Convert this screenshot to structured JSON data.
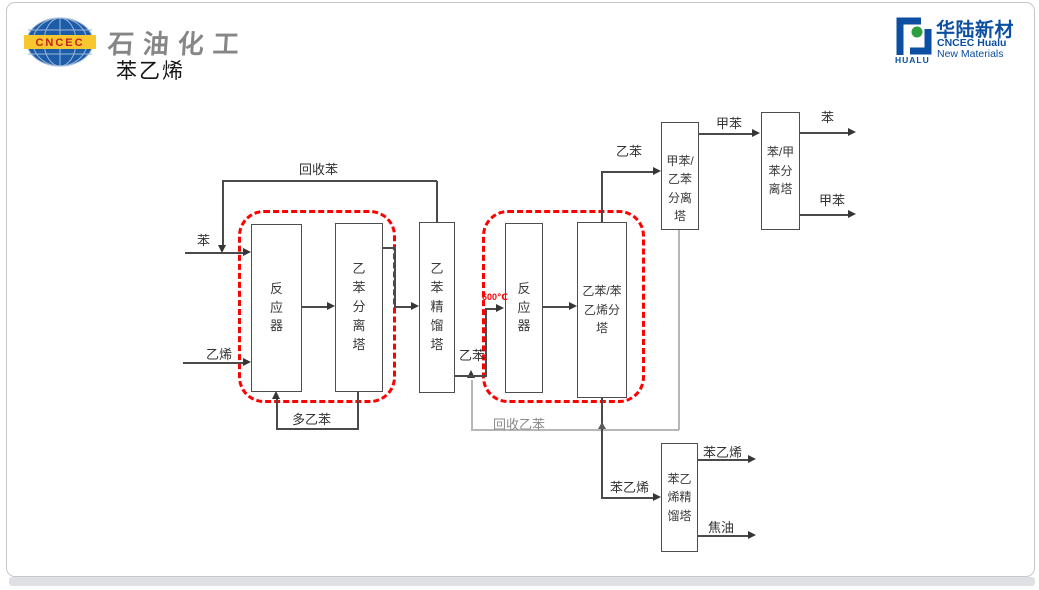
{
  "slide": {
    "brand_left": {
      "logo_text": "CNCEC",
      "dept": "石油化工"
    },
    "title": "苯乙烯",
    "brand_right": {
      "cn": "华陆新材",
      "en_line1": "CNCEC Hualu",
      "en_line2": "New Materials",
      "icon_caption": "HUALU"
    }
  },
  "diagram": {
    "towers": [
      {
        "id": "reactor-1",
        "label": "反\n应\n器"
      },
      {
        "id": "eb-separation-tower",
        "label": "乙\n苯\n分\n离\n塔"
      },
      {
        "id": "eb-distillation-tower",
        "label": "乙\n苯\n精\n馏\n塔"
      },
      {
        "id": "reactor-2",
        "label": "反\n应\n器"
      },
      {
        "id": "eb-styrene-splitter",
        "label": "乙苯/苯\n乙烯分\n塔"
      },
      {
        "id": "toluene-eb-separation-tower",
        "label": "甲苯/\n乙苯\n分离\n塔"
      },
      {
        "id": "benzene-toluene-separation-tower",
        "label": "苯/甲\n苯分\n离塔"
      },
      {
        "id": "styrene-distillation-tower",
        "label": "苯乙\n烯精\n馏塔"
      }
    ],
    "streams": [
      {
        "id": "benzene-feed",
        "text": "苯"
      },
      {
        "id": "recycle-benzene",
        "text": "回收苯"
      },
      {
        "id": "ethylene-feed",
        "text": "乙烯"
      },
      {
        "id": "poly-ethylbenzene",
        "text": "多乙苯"
      },
      {
        "id": "ethylbenzene-mid",
        "text": "乙苯"
      },
      {
        "id": "reactor2-temperature",
        "text": "600℃"
      },
      {
        "id": "recycle-ethylbenzene",
        "text": "回收乙苯"
      },
      {
        "id": "ethylbenzene-top",
        "text": "乙苯"
      },
      {
        "id": "toluene-mid",
        "text": "甲苯"
      },
      {
        "id": "benzene-out",
        "text": "苯"
      },
      {
        "id": "toluene-out",
        "text": "甲苯"
      },
      {
        "id": "styrene-feed",
        "text": "苯乙烯"
      },
      {
        "id": "styrene-out",
        "text": "苯乙烯"
      },
      {
        "id": "tar-out",
        "text": "焦油"
      }
    ],
    "colors": {
      "flow_line": "#4a4a4a",
      "recycle_line": "#b7b7b7",
      "highlight_dashed": "#ff0000",
      "temperature_text": "#ff0000",
      "brand_blue": "#0b4ea2",
      "logo_yellow": "#f6c72e",
      "logo_green": "#2f9e41",
      "dept_gray": "#868686"
    }
  }
}
